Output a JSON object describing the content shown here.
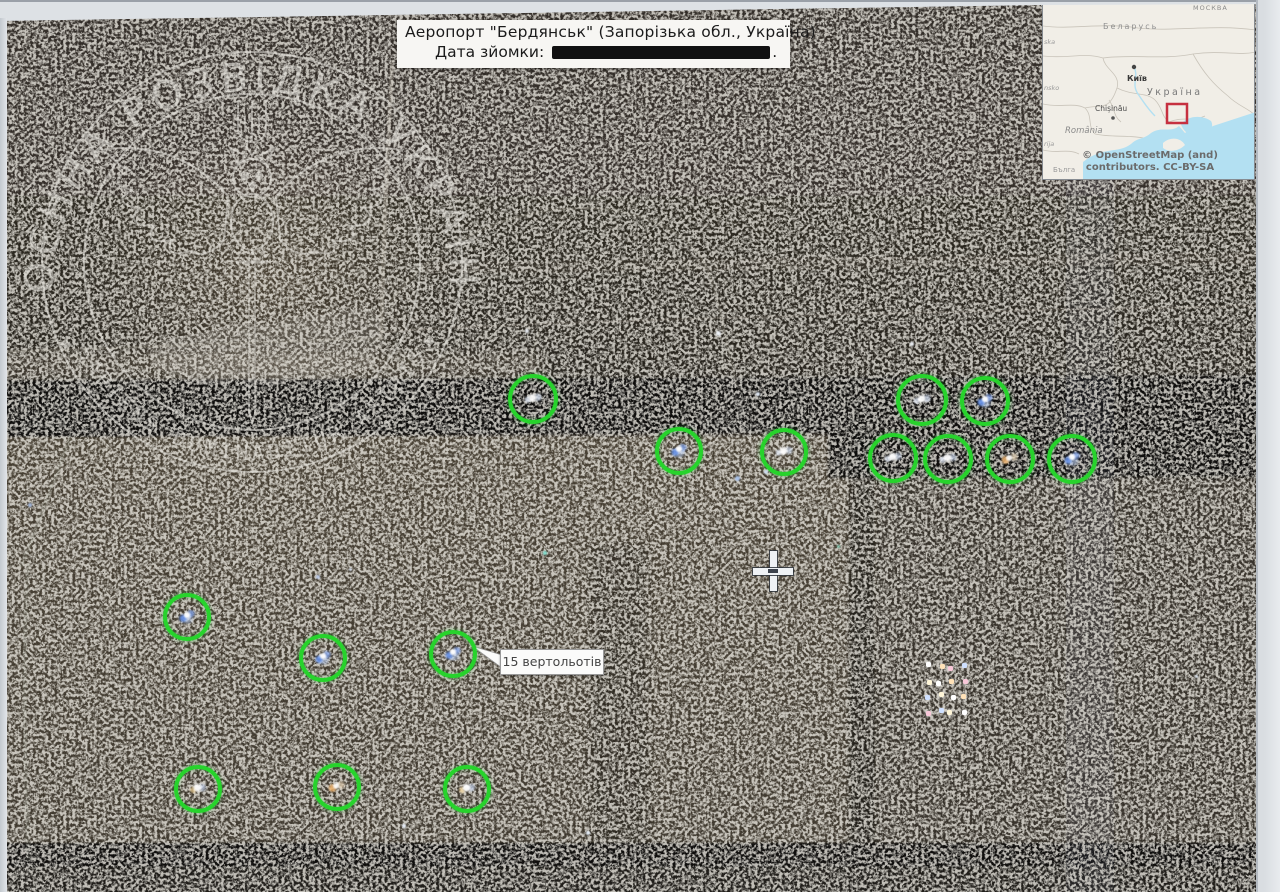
{
  "title_card": {
    "line1": "Аеропорт \"Бердянськ\" (Запорізька обл., Україна)",
    "line2_label": "Дата зйомки:",
    "line2_suffix": ".",
    "date_redacted": true
  },
  "callout": {
    "label": "15 вертольотів"
  },
  "watermark": {
    "ring_text": "ВОЄННА  РОЗВІДКА  УКРАЇНИ",
    "motto": "SAPIENS DOMINABITUR ASTRIS",
    "star_left": "✦",
    "star_right": "✦"
  },
  "inset_map": {
    "labels": {
      "moscow_partial": "МОСКВА",
      "belarus": "Беларусь",
      "kyiv": "Київ",
      "ukraine": "Україна",
      "chisinau": "Chișinău",
      "romania": "România",
      "polska_partial": "ska",
      "slovensko_partial": "nsko",
      "serbia_partial": "rija",
      "bulgaria_partial": "Бълга"
    },
    "attribution_line1": "© OpenStreetMap (and)",
    "attribution_line2": "contributors. CC-BY-SA",
    "marker_box_color": "#c63040",
    "water_color": "#b3e0f2",
    "land_color": "#f1eee7"
  },
  "markers": {
    "circle_color": "#27d32c",
    "count": 15,
    "circles": [
      {
        "x": 533,
        "y": 399,
        "r": 25,
        "tint": "white"
      },
      {
        "x": 679,
        "y": 451,
        "r": 24,
        "tint": "blue"
      },
      {
        "x": 784,
        "y": 452,
        "r": 24,
        "tint": "white"
      },
      {
        "x": 922,
        "y": 400,
        "r": 26,
        "tint": "white"
      },
      {
        "x": 985,
        "y": 401,
        "r": 25,
        "tint": "blue"
      },
      {
        "x": 893,
        "y": 458,
        "r": 25,
        "tint": "white"
      },
      {
        "x": 948,
        "y": 459,
        "r": 25,
        "tint": "white"
      },
      {
        "x": 1010,
        "y": 459,
        "r": 25,
        "tint": "orange"
      },
      {
        "x": 1072,
        "y": 459,
        "r": 25,
        "tint": "blue"
      },
      {
        "x": 187,
        "y": 617,
        "r": 24,
        "tint": "blue"
      },
      {
        "x": 323,
        "y": 658,
        "r": 24,
        "tint": "blue"
      },
      {
        "x": 453,
        "y": 654,
        "r": 24,
        "tint": "blue"
      },
      {
        "x": 198,
        "y": 789,
        "r": 24,
        "tint": "warm"
      },
      {
        "x": 337,
        "y": 787,
        "r": 24,
        "tint": "orange"
      },
      {
        "x": 467,
        "y": 789,
        "r": 24,
        "tint": "warm"
      }
    ]
  },
  "cursor": {
    "x": 773,
    "y": 571
  },
  "specks": [
    {
      "x": 527,
      "y": 331,
      "c": "#e8ecf2",
      "s": 4
    },
    {
      "x": 718,
      "y": 333,
      "c": "#eef2f8",
      "s": 5
    },
    {
      "x": 912,
      "y": 344,
      "c": "#e8ecf2",
      "s": 4
    },
    {
      "x": 737,
      "y": 478,
      "c": "#a9c2e8",
      "s": 5
    },
    {
      "x": 766,
      "y": 472,
      "c": "#cfdcf0",
      "s": 4
    },
    {
      "x": 318,
      "y": 577,
      "c": "#b9c8e6",
      "s": 4
    },
    {
      "x": 350,
      "y": 569,
      "c": "#dfe7f4",
      "s": 3
    },
    {
      "x": 545,
      "y": 553,
      "c": "#7fd8c8",
      "s": 4
    },
    {
      "x": 838,
      "y": 546,
      "c": "#8fd8c0",
      "s": 3
    },
    {
      "x": 404,
      "y": 826,
      "c": "#e8eef8",
      "s": 4
    },
    {
      "x": 588,
      "y": 833,
      "c": "#e4ecf6",
      "s": 4
    },
    {
      "x": 758,
      "y": 394,
      "c": "#dfe8f4",
      "s": 4
    },
    {
      "x": 1196,
      "y": 676,
      "c": "#d8e2ee",
      "s": 3
    },
    {
      "x": 30,
      "y": 505,
      "c": "#9fb4d8",
      "s": 4
    }
  ],
  "vehicle_cluster": {
    "x": 926,
    "y": 664,
    "cols": 4,
    "rows": 4,
    "dx": 11.5,
    "dy": 15,
    "colors": [
      "#ffffff",
      "#ffe2b8",
      "#f8c8d8",
      "#cfe0ff",
      "#fff6d8"
    ]
  },
  "colors": {
    "photo_border": "#dde1e5",
    "satellite_base": "#2e2922",
    "runway_black": "#0b0a09",
    "marker_green": "#27d32c"
  }
}
